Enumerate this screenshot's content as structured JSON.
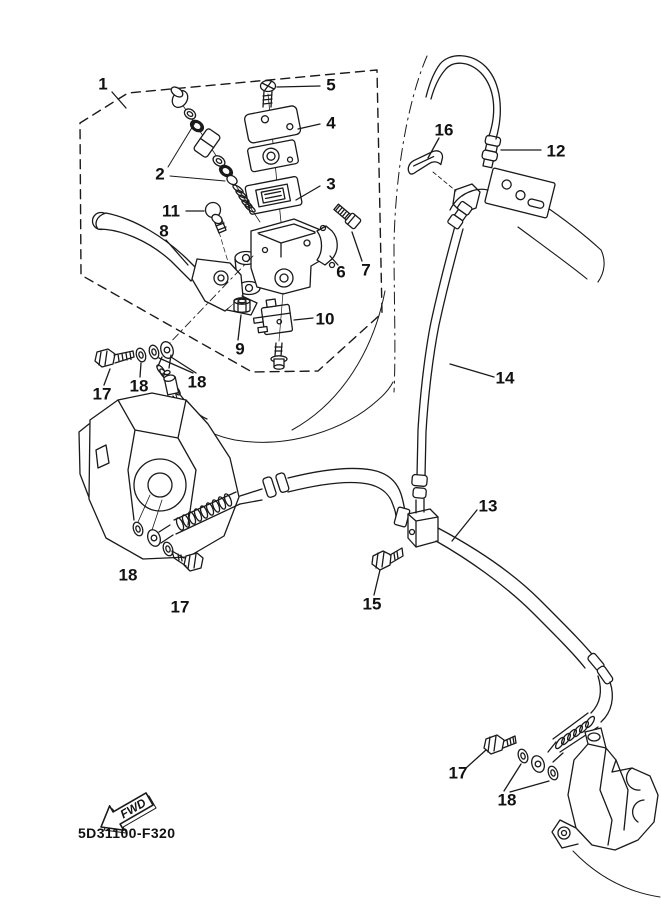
{
  "document": {
    "part_code": "5D31100-F320",
    "fwd_label": "FWD"
  },
  "callouts": [
    {
      "id": "callout-1",
      "label": "1"
    },
    {
      "id": "callout-2",
      "label": "2"
    },
    {
      "id": "callout-3",
      "label": "3"
    },
    {
      "id": "callout-4",
      "label": "4"
    },
    {
      "id": "callout-5",
      "label": "5"
    },
    {
      "id": "callout-6",
      "label": "6"
    },
    {
      "id": "callout-7",
      "label": "7"
    },
    {
      "id": "callout-8",
      "label": "8"
    },
    {
      "id": "callout-9",
      "label": "9"
    },
    {
      "id": "callout-10",
      "label": "10"
    },
    {
      "id": "callout-11",
      "label": "11"
    },
    {
      "id": "callout-12",
      "label": "12"
    },
    {
      "id": "callout-13",
      "label": "13"
    },
    {
      "id": "callout-14",
      "label": "14"
    },
    {
      "id": "callout-15",
      "label": "15"
    },
    {
      "id": "callout-16",
      "label": "16"
    },
    {
      "id": "callout-17-master",
      "label": "17"
    },
    {
      "id": "callout-18-master-a",
      "label": "18"
    },
    {
      "id": "callout-18-master-b",
      "label": "18"
    },
    {
      "id": "callout-18-left-caliper",
      "label": "18"
    },
    {
      "id": "callout-17-left-caliper",
      "label": "17"
    },
    {
      "id": "callout-17-right-caliper",
      "label": "17"
    },
    {
      "id": "callout-18-right-caliper",
      "label": "18"
    }
  ]
}
